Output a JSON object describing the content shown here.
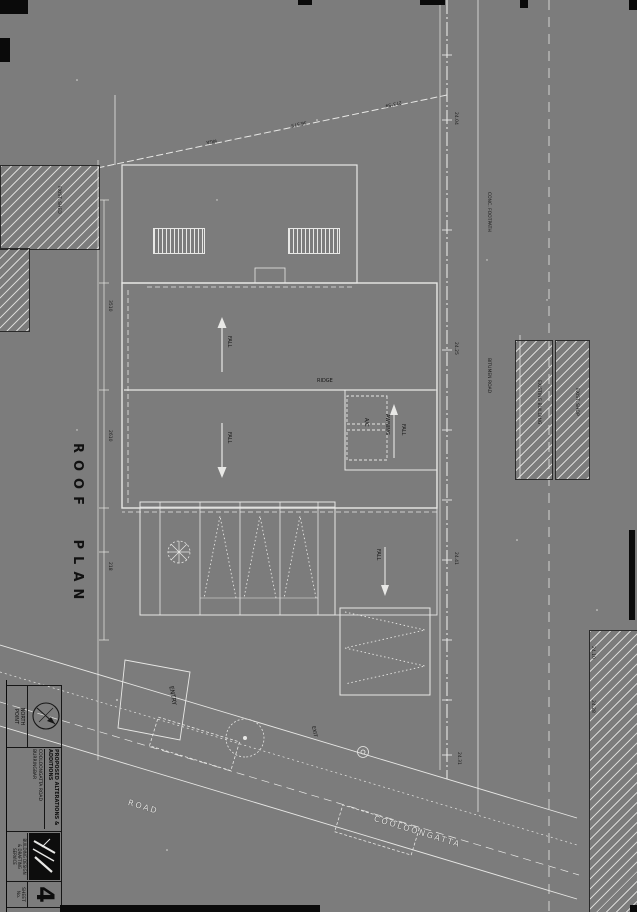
{
  "sheet": {
    "plan_title": "ROOF PLAN",
    "sheet_number": "4"
  },
  "labels": {
    "ridge": "RIDGE",
    "fall": "FALL",
    "awning": "AWNING",
    "entry": "ENTRY",
    "exit": "EXIT",
    "ac_unit": "A/C",
    "footpath": "CONC. FOOTPATH",
    "bitumen": "BITUMEN ROAD",
    "road_name_1": "COOLOONGATTA",
    "road_name_2": "ROAD",
    "existing_building": "EXISTING BUILDING",
    "existing_shop": "EXIST. SHOP",
    "existing_shed": "EXIST. SHED"
  },
  "survey": {
    "bearing_1": "273°54'",
    "bearing_2": "36.575",
    "bearing_3": "MGA",
    "levels": [
      "24.04",
      "24.25",
      "24.41",
      "24.10",
      "24.28",
      "24.31"
    ],
    "dims": [
      "3510",
      "2610",
      "218"
    ]
  },
  "title_block": {
    "north_label_1": "NORTH",
    "north_label_2": "POINT",
    "project_line": "PROPOSED ALTERATIONS & ADDITIONS",
    "address_line_1": "COOLOONGATTA ROAD",
    "address_line_2": "BURRINGBAR",
    "firm_line_1": "BUILDING DESIGN",
    "firm_line_2": "& DRAFTING",
    "firm_line_3": "SERVICE",
    "sheet_label_1": "SHEET",
    "sheet_label_2": "No."
  }
}
